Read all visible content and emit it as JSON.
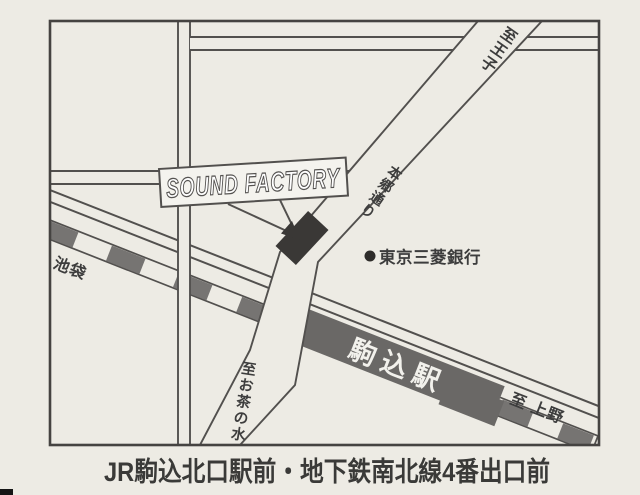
{
  "map": {
    "caption": "JR駒込北口駅前・地下鉄南北線4番出口前",
    "venue": {
      "label": "SOUND FACTORY"
    },
    "station": {
      "label": "駒込駅"
    },
    "bank": {
      "label": "東京三菱銀行",
      "marker": "bullet-circle"
    },
    "road_labels": {
      "hongo_dori": "本郷通り",
      "to_oji": "至王子",
      "to_ikebukuro": "至 池袋",
      "to_ueno": "至 上野",
      "to_ochanomizu": "至お茶の水"
    },
    "colors": {
      "paper": "#edebe4",
      "line": "#52504e",
      "railway_gray": "#767472",
      "station_gray": "#6a6866",
      "building_dark": "#3a3836",
      "caption_dark": "#3a3a38"
    }
  }
}
